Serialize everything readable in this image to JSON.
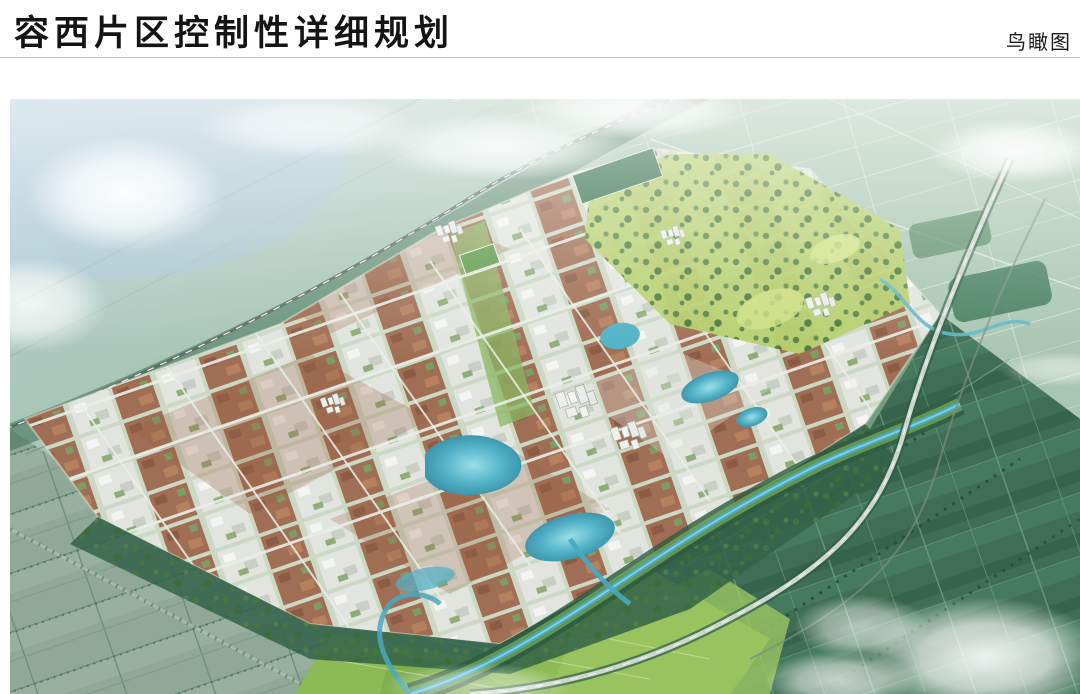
{
  "header": {
    "title": "容西片区控制性详细规划",
    "corner_label": "鸟瞰图"
  },
  "rendering": {
    "colors": {
      "sky_haze": "#b5cdd9",
      "farmland_pale": "#a9c6b2",
      "farmland_dark": "#3f6e55",
      "farmland_muted": "#8fa897",
      "fields_bright": "#8cba55",
      "city_street": "#ccd8c4",
      "roof_red": "#a06e54",
      "building_white": "#e2e5df",
      "park_green": "#b4cf6a",
      "water": "#4fb2c6",
      "cloud": "#ffffff"
    }
  }
}
